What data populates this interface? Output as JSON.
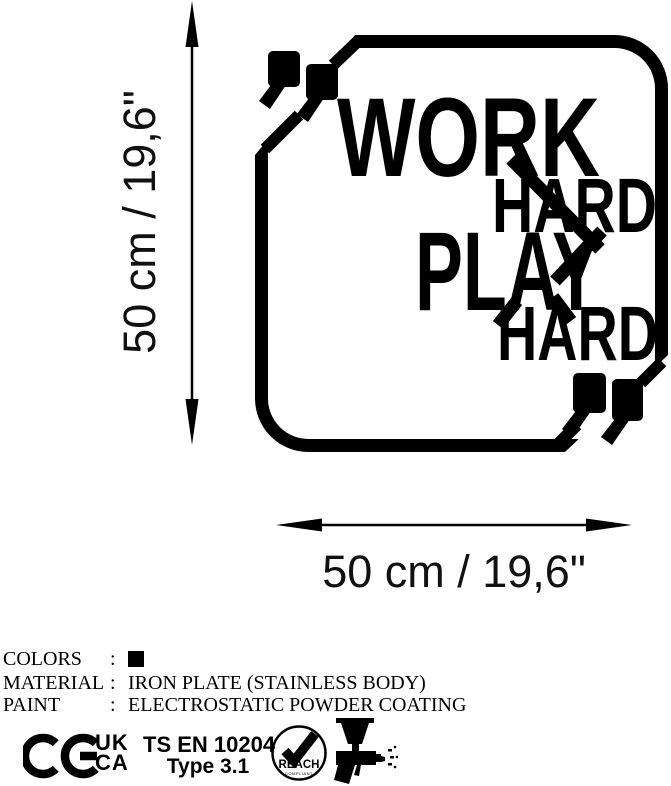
{
  "artwork": {
    "lines": [
      "WORK",
      "HARD",
      "PLAY",
      "HARD"
    ],
    "quote_icon": "double-quote-mark"
  },
  "dimensions": {
    "height_label": "50 cm / 19,6\"",
    "width_label": "50 cm / 19,6\""
  },
  "specs": {
    "separator": ":",
    "rows": [
      {
        "label": "COLORS",
        "value": "",
        "swatch_color": "#000000"
      },
      {
        "label": "MATERIAL",
        "value": "IRON PLATE (STAINLESS BODY)"
      },
      {
        "label": "PAINT",
        "value": "ELECTROSTATIC POWDER COATING"
      }
    ]
  },
  "certifications": {
    "ce_label": "CE",
    "ukca_line1": "UK",
    "ukca_line2": "CA",
    "standard_line1": "TS EN 10204",
    "standard_line2": "Type 3.1",
    "reach_label": "REACH",
    "reach_sub": "COMPLIANT",
    "spray_gun_icon": "paint-spray-gun"
  },
  "colors": {
    "ink": "#000000",
    "background": "#ffffff"
  }
}
